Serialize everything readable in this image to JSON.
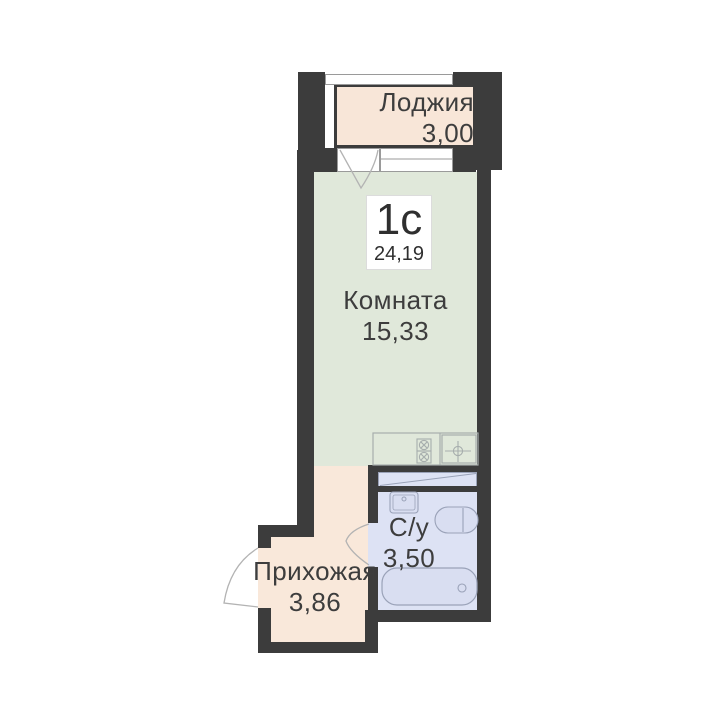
{
  "title": "Планировка квартиры-студии",
  "badge": {
    "type_label": "1с",
    "total_area": "24,19"
  },
  "rooms": {
    "loggia": {
      "label": "Лоджия",
      "area": "3,00"
    },
    "living": {
      "label": "Комната",
      "area": "15,33"
    },
    "hallway": {
      "label": "Прихожая",
      "area": "3,86"
    },
    "bathroom": {
      "label": "С/у",
      "area": "3,50"
    }
  },
  "icons": [
    "stove-icon",
    "kitchen-sink-icon",
    "bath-sink-icon",
    "toilet-icon",
    "bathtub-icon",
    "balcony-door-arc-icon",
    "entrance-door-arc-icon",
    "bathroom-door-arc-icon"
  ],
  "colors": {
    "wall": "#3c3c3c",
    "loggia-fill": "#f8e6d8",
    "hallway-fill": "#f9e8da",
    "room-fill": "#e0e8da",
    "bath-fill": "#dde2f4",
    "fixture-fill": "#d9def1",
    "fixture-stroke": "#9aa2b8",
    "outline": "#b3b3b3",
    "kitchen-stroke": "#a7aead",
    "text": "#3d3d3d",
    "badge-bg": "#ffffff",
    "page-bg": "#ffffff"
  }
}
